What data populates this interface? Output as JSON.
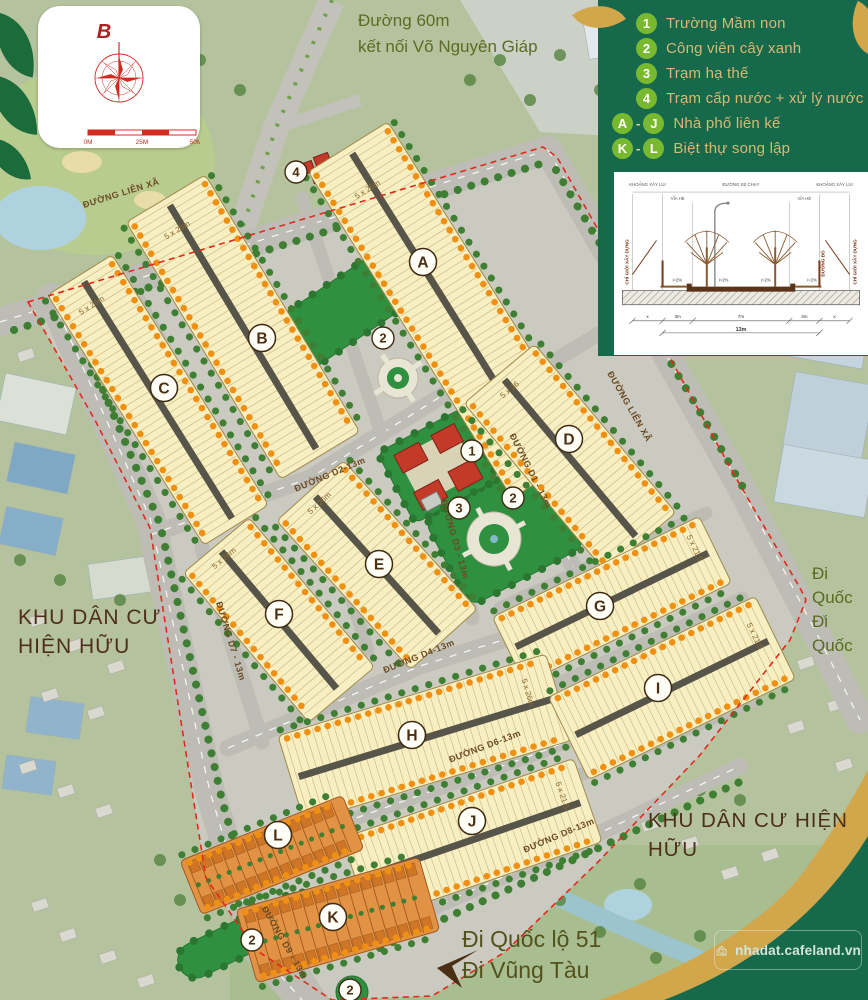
{
  "poster": {
    "width": 868,
    "height": 1000
  },
  "top_note": {
    "line1": "Đường 60m",
    "line2": "kết nối Võ Nguyên Giáp"
  },
  "logo": {
    "compass_letter": "B",
    "scale_labels": [
      "0M",
      "25M",
      "50M"
    ]
  },
  "legend": {
    "items": [
      {
        "type": "num",
        "badge": "1",
        "label": "Trường Mầm non"
      },
      {
        "type": "num",
        "badge": "2",
        "label": "Công viên cây xanh"
      },
      {
        "type": "num",
        "badge": "3",
        "label": "Trạm hạ thế"
      },
      {
        "type": "num",
        "badge": "4",
        "label": "Trạm cấp nước + xử lý nước thải"
      },
      {
        "type": "range",
        "badge_a": "A",
        "badge_b": "J",
        "label": "Nhà phố liên kế"
      },
      {
        "type": "range",
        "badge_a": "K",
        "badge_b": "L",
        "label": "Biệt thự song lập"
      }
    ]
  },
  "section": {
    "top_left": "KHOẢNG XÂY LÙI",
    "top_center": "ĐƯỜNG XE CHẠY",
    "top_right": "KHOẢNG XÂY LÙI",
    "sidewalk": "VỈA HÈ",
    "left_vertical": "CHỈ GIỚI XÂY DỰNG",
    "right_vertical": "CHỈ GIỚI XÂY DỰNG",
    "red_line": "ĐƯỜNG ĐỎ",
    "slope": "i=2%",
    "dims": [
      "x",
      "3m",
      "7m",
      "3m",
      "x"
    ],
    "total": "13m"
  },
  "map": {
    "blocks": [
      {
        "letter": "A",
        "size": "5 x 26m"
      },
      {
        "letter": "B",
        "size": "5 x 26m"
      },
      {
        "letter": "C",
        "size": "5 x 26m"
      },
      {
        "letter": "D",
        "size": "5 x 26"
      },
      {
        "letter": "E",
        "size": "5 x 26m"
      },
      {
        "letter": "F",
        "size": "5 x 26m"
      },
      {
        "letter": "G",
        "size": "5 x 21.5"
      },
      {
        "letter": "H",
        "size": "5 x 26m"
      },
      {
        "letter": "I",
        "size": "5 x 21.5"
      },
      {
        "letter": "J",
        "size": "5 x 21.5"
      },
      {
        "letter": "K",
        "size": ""
      },
      {
        "letter": "L",
        "size": ""
      }
    ],
    "road_labels": [
      "ĐƯỜNG LIÊN XÃ",
      "ĐƯỜNG LIÊN XÃ",
      "ĐƯỜNG D1 - 13m",
      "ĐƯỜNG D2-13m",
      "ĐƯỜNG D3 - 13m",
      "ĐƯỜNG D4-13m",
      "ĐƯỜNG D6-13m",
      "ĐƯỜNG D7 - 13m",
      "ĐƯỜNG D8-13m",
      "ĐƯỜNG D9 - 13m"
    ],
    "poi_badges": [
      "4",
      "2",
      "1",
      "2",
      "3",
      "2",
      "2"
    ],
    "area_left_line1": "KHU DÂN CƯ",
    "area_left_line2": "HIỆN HỮU",
    "area_right": "KHU DÂN CƯ HIỆN HỮU",
    "dir_right_line1": "Đi Quốc",
    "dir_right_line2": "Đi Quốc",
    "dir_bottom_line1": "Đi Quốc lộ 51",
    "dir_bottom_line2": "Đi Vũng Tàu"
  },
  "watermark": {
    "text": "nhadat.cafeland.vn"
  },
  "colors": {
    "panel_green": "#17694B",
    "badge_green": "#79B92F",
    "gold": "#D2A64B",
    "legend_text": "#D8B873",
    "cream": "#F7EEC2",
    "lot_dot": "#F09012",
    "park": "#2F9040",
    "road": "#BDBDB6",
    "boundary_red": "#E2291B",
    "villa": "#E29244",
    "label_brown": "#6B4A23",
    "text_brown": "#4A2F12"
  }
}
